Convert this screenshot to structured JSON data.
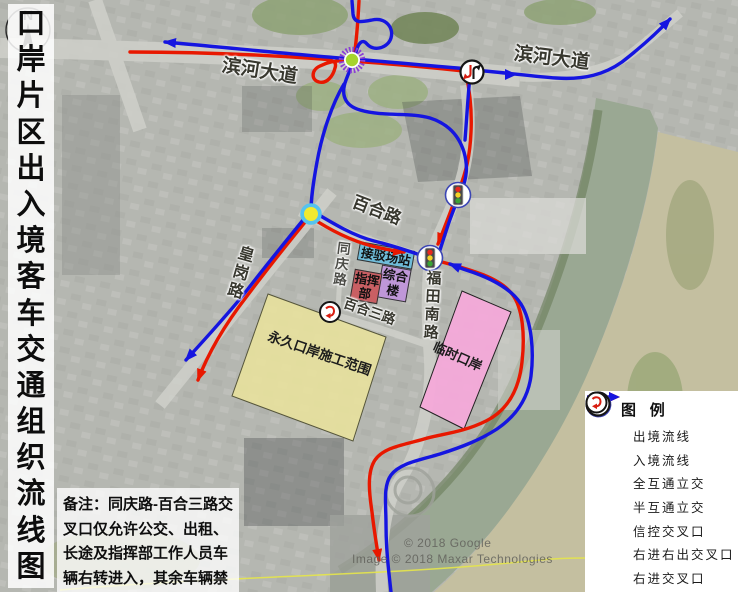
{
  "title": {
    "text": "口岸片区出入境客车交通组织流线图",
    "chars": [
      "口",
      "岸",
      "片",
      "区",
      "出",
      "入",
      "境",
      "客",
      "车",
      "交",
      "通",
      "组",
      "织",
      "流",
      "线",
      "图"
    ]
  },
  "roads": {
    "binhe_west": "滨河大道",
    "binhe_east": "滨河大道",
    "baihe": "百合路",
    "huanggang": "皇岗路",
    "tongqing": "同庆路",
    "futiannan": "福田南路",
    "baihesan": "百合三路"
  },
  "areas": {
    "yongjiu": "永久口岸施工范围",
    "linshi": "临时口岸",
    "jiebo": "接驳场站",
    "zonghe": "综合楼",
    "zhihui": "指挥部"
  },
  "legend": {
    "title": "图 例",
    "items": [
      {
        "icon": "red-arrow",
        "label": "出境流线"
      },
      {
        "icon": "blue-arrow",
        "label": "入境流线"
      },
      {
        "icon": "full-interchange",
        "label": "全互通立交"
      },
      {
        "icon": "half-interchange",
        "label": "半互通立交"
      },
      {
        "icon": "signal-intersection",
        "label": "信控交叉口"
      },
      {
        "icon": "right-in-right-out",
        "label": "右进右出交叉口"
      },
      {
        "icon": "right-in",
        "label": "右进交叉口"
      }
    ]
  },
  "note": {
    "text": "备注：同庆路-百合三路交叉口仅允许公交、出租、长途及指挥部工作人员车辆右转进入，其余车辆禁止驶入。"
  },
  "compass": {
    "label": "N"
  },
  "watermarks": {
    "google": "© 2018 Google",
    "imagery": "Image © 2018 Maxar Technologies"
  },
  "colors": {
    "exit_line": "#e81800",
    "entry_line": "#1515e0",
    "full_interchange_center": "#a6d42c",
    "full_interchange_ring": "#8a3fd4",
    "half_interchange_fill": "#f2ea30",
    "half_interchange_ring": "#55c3ee",
    "construction_area": "#e9e39c",
    "temporary_port": "#f4a9d9",
    "transfer_station": "#6fbcd9",
    "complex_building": "#bf97d8",
    "command_post": "#c95f63"
  }
}
